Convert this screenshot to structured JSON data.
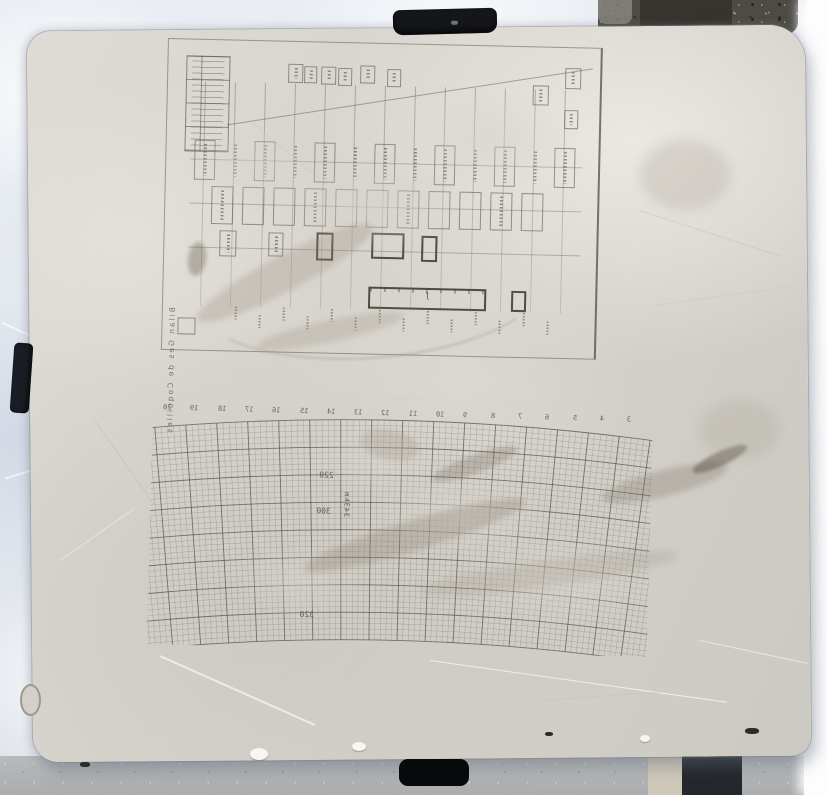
{
  "scene": {
    "subject": "Lithographic limestone printing stone engraved with two mirrored figures, photographed from above lying on snow beside gravel and concrete",
    "colors": {
      "snow": "#e7ebf1",
      "overexposed_strip": "#fdfdfe",
      "gravel": "#4e4b45",
      "concrete": "#b2b4b6",
      "concrete_beige_strip": "#cfc8b9",
      "concrete_dark_stripe": "#24272c",
      "stone": "#d6d3cd",
      "engraving": "#5a574e",
      "clip": "#14161b"
    }
  },
  "clips": {
    "count": 3,
    "positions": [
      "top-center",
      "left-edge",
      "bottom-center"
    ]
  },
  "top_figure": {
    "kind": "engraved flow/genealogy-style chart of small connected boxes, mirrored for printing",
    "side_title": "Bilan Ges de Coquilles",
    "side_title_legibility": "vertical caption along left frame edge; mirrored, only partly legible",
    "legend_table": {
      "rows": 4,
      "columns": 2,
      "cell_text": "illegible engraved entries"
    },
    "rows_of_boxes": 4,
    "bold_component_boxes": 5,
    "long_bottom_bar": 1,
    "bottom_edge": "row of tiny illegible engraved tick labels"
  },
  "grid_figure": {
    "kind": "fan-shaped curved coordinate grid, mirrored for printing",
    "top_scale_numbers": [
      "20",
      "19",
      "18",
      "17",
      "16",
      "15",
      "14",
      "13",
      "12",
      "11",
      "10",
      "9",
      "8",
      "7",
      "6",
      "5",
      "4",
      "3"
    ],
    "arc_labels": [
      "220",
      "300",
      "320"
    ],
    "vertical_label": "343km",
    "label_legibility": "numbers engraved mirrored; they read left-to-right when printed"
  }
}
